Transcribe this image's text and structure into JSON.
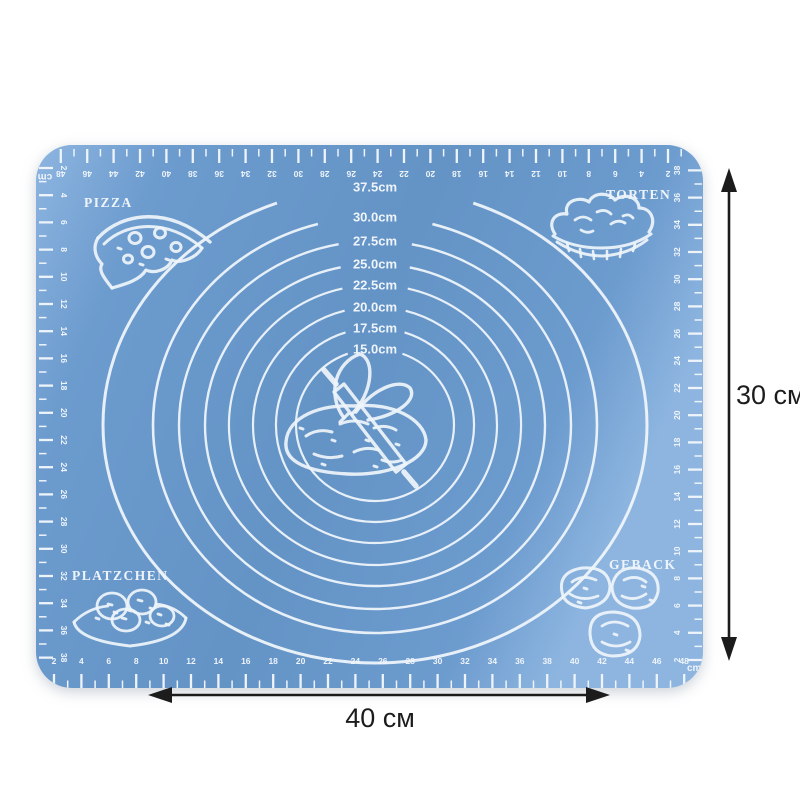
{
  "scene": {
    "background": "#ffffff"
  },
  "colors": {
    "mat": "#6c9bce",
    "mat_light": "#8db5e0",
    "mat_shade": "#6493c6",
    "marking": "#eef4fa",
    "arrow": "#1c1c1c",
    "background": "#ffffff"
  },
  "mat": {
    "corner_labels": {
      "top_left": "PIZZA",
      "top_right": "TORTEN",
      "bottom_left": "PLATZCHEN",
      "bottom_right": "GEBACK"
    },
    "circles": [
      {
        "label": "37.5cm",
        "diameter_cm": 37.5
      },
      {
        "label": "30.0cm",
        "diameter_cm": 30.0
      },
      {
        "label": "27.5cm",
        "diameter_cm": 27.5
      },
      {
        "label": "25.0cm",
        "diameter_cm": 25.0
      },
      {
        "label": "22.5cm",
        "diameter_cm": 22.5
      },
      {
        "label": "20.0cm",
        "diameter_cm": 20.0
      },
      {
        "label": "17.5cm",
        "diameter_cm": 17.5
      },
      {
        "label": "15.0cm",
        "diameter_cm": 15.0
      }
    ],
    "rulers": {
      "unit_label": "cm",
      "top": {
        "numbers": [
          48,
          46,
          44,
          42,
          40,
          38,
          36,
          34,
          32,
          30,
          28,
          26,
          24,
          22,
          20,
          18,
          16,
          14,
          12,
          10,
          8,
          6,
          4,
          2
        ]
      },
      "bottom": {
        "numbers": [
          2,
          4,
          6,
          8,
          10,
          12,
          14,
          16,
          18,
          20,
          22,
          24,
          26,
          28,
          30,
          32,
          34,
          36,
          38,
          40,
          42,
          44,
          46,
          48
        ]
      },
      "left": {
        "numbers": [
          2,
          4,
          6,
          8,
          10,
          12,
          14,
          16,
          18,
          20,
          22,
          24,
          26,
          28,
          30,
          32,
          34,
          36,
          38
        ]
      },
      "right": {
        "numbers": [
          38,
          36,
          34,
          32,
          30,
          28,
          26,
          24,
          22,
          20,
          18,
          16,
          14,
          12,
          10,
          8,
          6,
          4,
          2
        ]
      }
    }
  },
  "annotations": {
    "width_label": "40 см",
    "height_label": "30 см"
  }
}
